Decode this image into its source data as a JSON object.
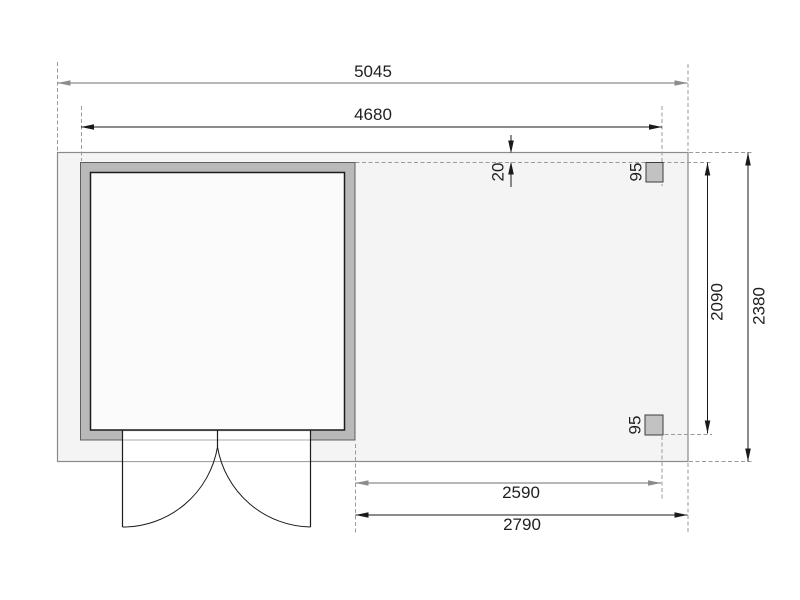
{
  "drawing": {
    "type": "floor-plan-with-side-roof",
    "dimensions": {
      "overall_width": "5045",
      "cabin_width": "4680",
      "roof_edge_offset": "20",
      "post_top_size": "95",
      "post_bottom_size": "95",
      "post_span_depth": "2090",
      "overall_depth": "2380",
      "annex_width_inner": "2590",
      "annex_width_outer": "2790"
    },
    "colors": {
      "deck_fill": "#f4f4f4",
      "deck_outline": "#8a8a8a",
      "wall_fill": "#b9b9b9",
      "floor_fill": "#fbfbfb",
      "post_fill": "#c2c2c2",
      "dimension_line_black": "#1a1a1a",
      "dimension_line_gray": "#8c8c8c",
      "guide_dash": "#9a9a9a",
      "text": "#1f1f1f"
    }
  }
}
